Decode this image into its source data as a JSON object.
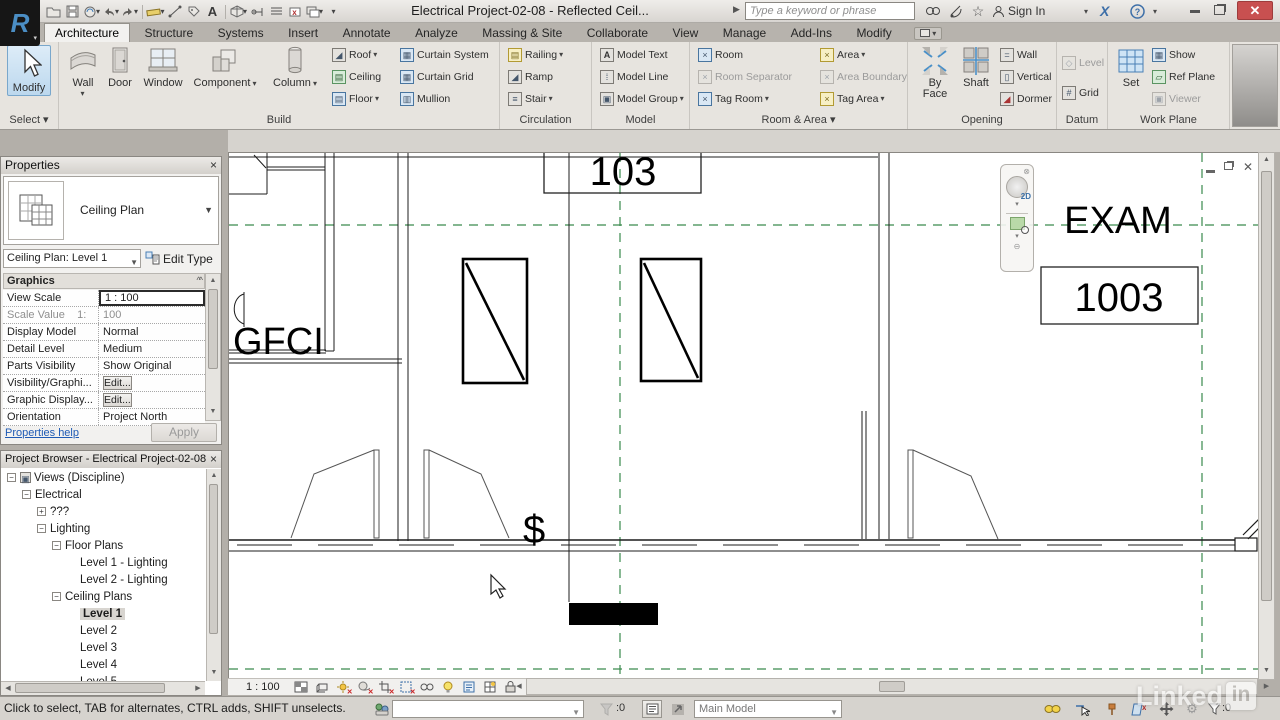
{
  "titlebar": {
    "title": "Electrical Project-02-08 - Reflected Ceil...",
    "search_placeholder": "Type a keyword or phrase",
    "sign_in": "Sign In"
  },
  "tabs": [
    {
      "label": "Architecture"
    },
    {
      "label": "Structure"
    },
    {
      "label": "Systems"
    },
    {
      "label": "Insert"
    },
    {
      "label": "Annotate"
    },
    {
      "label": "Analyze"
    },
    {
      "label": "Massing & Site"
    },
    {
      "label": "Collaborate"
    },
    {
      "label": "View"
    },
    {
      "label": "Manage"
    },
    {
      "label": "Add-Ins"
    },
    {
      "label": "Modify"
    }
  ],
  "ribbon": {
    "select": {
      "panel": "Select",
      "modify": "Modify"
    },
    "build": {
      "panel": "Build",
      "wall": "Wall",
      "door": "Door",
      "window": "Window",
      "component": "Component",
      "column": "Column",
      "roof": "Roof",
      "ceiling": "Ceiling",
      "floor": "Floor",
      "curtain_system": "Curtain System",
      "curtain_grid": "Curtain Grid",
      "mullion": "Mullion"
    },
    "circulation": {
      "panel": "Circulation",
      "railing": "Railing",
      "ramp": "Ramp",
      "stair": "Stair"
    },
    "model": {
      "panel": "Model",
      "model_text": "Model Text",
      "model_line": "Model Line",
      "model_group": "Model Group"
    },
    "room_area": {
      "panel": "Room & Area",
      "room": "Room",
      "room_separator": "Room Separator",
      "tag_room": "Tag Room",
      "area": "Area",
      "area_boundary": "Area Boundary",
      "tag_area": "Tag Area"
    },
    "opening": {
      "panel": "Opening",
      "by_face": "By Face",
      "shaft": "Shaft",
      "wall": "Wall",
      "vertical": "Vertical",
      "dormer": "Dormer"
    },
    "datum": {
      "panel": "Datum",
      "level": "Level",
      "grid": "Grid"
    },
    "work_plane": {
      "panel": "Work Plane",
      "set": "Set",
      "show": "Show",
      "ref_plane": "Ref Plane",
      "viewer": "Viewer"
    }
  },
  "properties": {
    "title": "Properties",
    "type_name": "Ceiling Plan",
    "instance": "Ceiling Plan: Level 1",
    "edit_type": "Edit Type",
    "section": "Graphics",
    "rows": [
      {
        "label": "View Scale",
        "value": "1 : 100"
      },
      {
        "label": "Scale Value    1:",
        "value": "100"
      },
      {
        "label": "Display Model",
        "value": "Normal"
      },
      {
        "label": "Detail Level",
        "value": "Medium"
      },
      {
        "label": "Parts Visibility",
        "value": "Show Original"
      },
      {
        "label": "Visibility/Graphi...",
        "value": "Edit..."
      },
      {
        "label": "Graphic Display...",
        "value": "Edit..."
      },
      {
        "label": "Orientation",
        "value": "Project North"
      }
    ],
    "help": "Properties help",
    "apply": "Apply"
  },
  "browser": {
    "title": "Project Browser - Electrical Project-02-08",
    "items": [
      {
        "label": "Views (Discipline)"
      },
      {
        "label": "Electrical"
      },
      {
        "label": "???"
      },
      {
        "label": "Lighting"
      },
      {
        "label": "Floor Plans"
      },
      {
        "label": "Level 1 - Lighting"
      },
      {
        "label": "Level 2 - Lighting"
      },
      {
        "label": "Ceiling Plans"
      },
      {
        "label": "Level 1"
      },
      {
        "label": "Level 2"
      },
      {
        "label": "Level 3"
      },
      {
        "label": "Level 4"
      },
      {
        "label": "Level 5"
      }
    ]
  },
  "canvas": {
    "room_tag": "103",
    "exam_label": "EXAM",
    "exam_tag": "1003",
    "gfci_label": "GFCI",
    "switch_symbol": "$"
  },
  "view_bar": {
    "scale": "1 : 100"
  },
  "status": {
    "hint": "Click to select, TAB for alternates, CTRL adds, SHIFT unselects.",
    "selection_count": ":0",
    "main_model": "Main Model",
    "filter_count": ":0"
  },
  "watermark": {
    "name": "Linked",
    "badge": "in"
  },
  "colors": {
    "reference_green": "#3a8a4d",
    "selection_blue": "#bcd8ee",
    "close_red": "#c85050"
  }
}
